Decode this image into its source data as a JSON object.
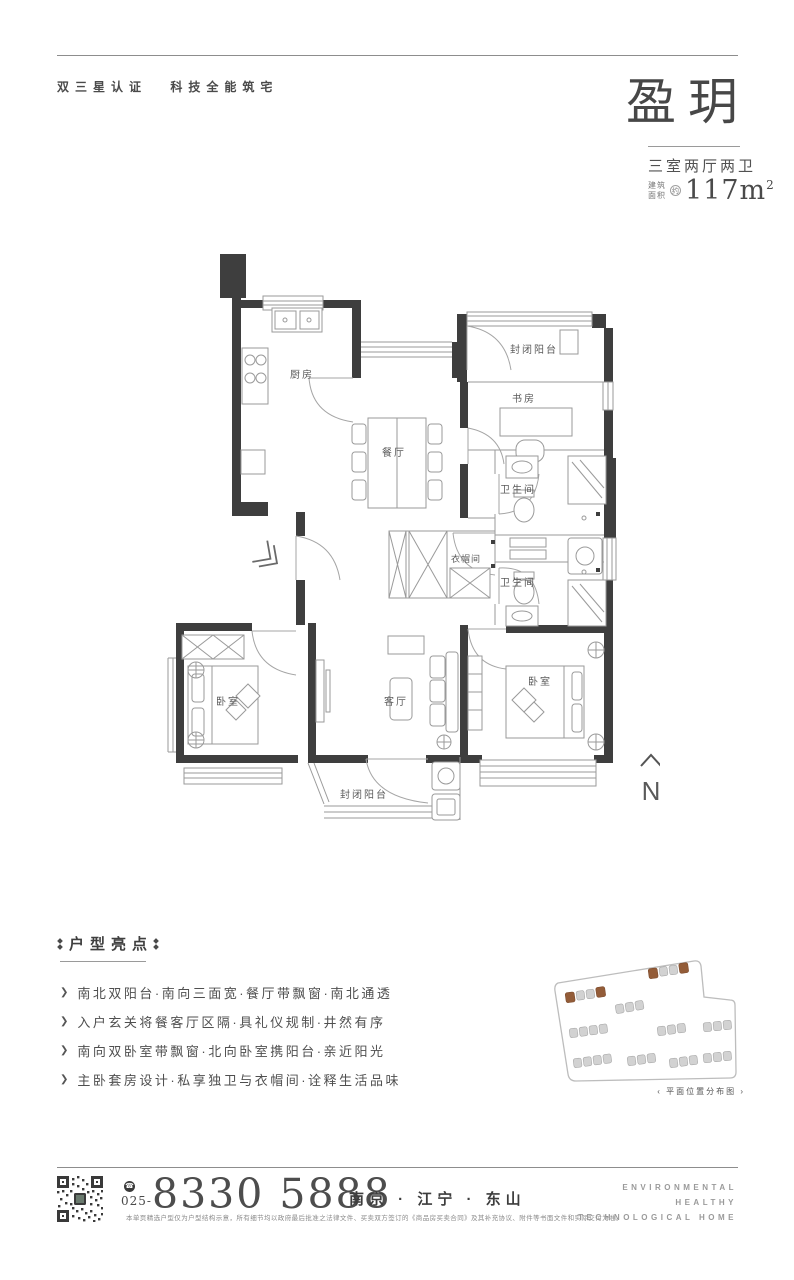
{
  "header": {
    "cert_label": "双三星认证",
    "tech_label": "科技全能筑宅",
    "title": "盈玥",
    "layout": "三室两厅两卫",
    "area_prefix_line1": "建筑",
    "area_prefix_line2": "面积",
    "area_approx": "约",
    "area_value": "117m",
    "area_unit_sup": "2"
  },
  "floorplan": {
    "rooms": {
      "kitchen": "厨房",
      "dining": "餐厅",
      "balcony_top": "封闭阳台",
      "study": "书房",
      "bath_top": "卫生间",
      "bath_bottom": "卫生间",
      "closet": "衣帽间",
      "bedroom_left": "卧室",
      "living": "客厅",
      "bedroom_right": "卧室",
      "balcony_bottom": "封闭阳台"
    },
    "north_label": "N"
  },
  "highlights": {
    "heading": "户型亮点",
    "bullet_icon": "❯",
    "items": [
      "南北双阳台·南向三面宽·餐厅带飘窗·南北通透",
      "入户玄关将餐客厅区隔·具礼仪规制·井然有序",
      "南向双卧室带飘窗·北向卧室携阳台·亲近阳光",
      "主卧套房设计·私享独卫与衣帽间·诠释生活品味"
    ]
  },
  "siteplan": {
    "caption": "‹ 平面位置分布图 ›",
    "highlight_color": "#935c38",
    "building_color": "#d2d2d2"
  },
  "footer": {
    "phone_icon": "☎",
    "area_code": "025-",
    "phone_number": "8330 5888",
    "location": "南京 · 江宁 · 东山",
    "slogan": [
      "ENVIRONMENTAL",
      "HEALTHY",
      "TECHNOLOGICAL HOME"
    ],
    "disclaimer": "本单页精选户型仅为户型结构示意，所有细节均以政府最后批准之法律文件、买卖双方签订的《商品房买卖合同》及其补充协议、附件等书面文件和实际交付为准。"
  }
}
